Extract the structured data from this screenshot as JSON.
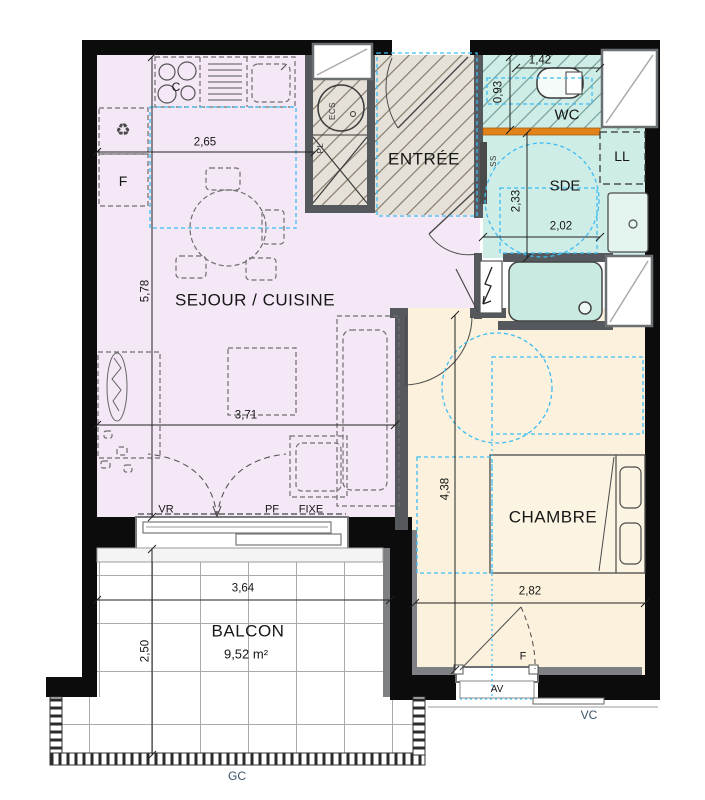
{
  "plan": {
    "title": "Apartment floor plan",
    "rooms": {
      "sejour": "SEJOUR / CUISINE",
      "entree": "ENTRÉE",
      "wc": "WC",
      "sde": "SDE",
      "ll": "LL",
      "chambre": "CHAMBRE",
      "balcon": "BALCON",
      "balcon_area": "9,52 m²"
    },
    "dimensions": {
      "kitchen_width": "2,65",
      "sejour_height": "5,78",
      "sejour_width": "3,71",
      "wc_depth": "0,93",
      "wc_width": "1,42",
      "sde_height": "2,33",
      "sde_width": "2,02",
      "chambre_height": "4,38",
      "chambre_width": "2,82",
      "balcon_width": "3,64",
      "balcon_depth": "2,50"
    },
    "tags": {
      "pl": "PL",
      "ecs": "ECS",
      "ss": "SS",
      "cooktop": "C",
      "fridge": "F",
      "recycle": "♻",
      "vr": "VR",
      "pf": "PF",
      "fixe": "FIXE",
      "window_f": "F",
      "av": "AV",
      "vc": "VC",
      "gc": "GC"
    },
    "colors": {
      "sejour_floor": "#f4e8f6",
      "chambre_floor": "#fbf1dc",
      "wet_room_floor": "#cfede7",
      "entree_floor": "#e6e1d8",
      "accessibility_blue": "#3fbdf2",
      "partition_orange": "#e2821a",
      "wall_black": "#0c0c0c",
      "wall_gray": "#55585c"
    }
  }
}
